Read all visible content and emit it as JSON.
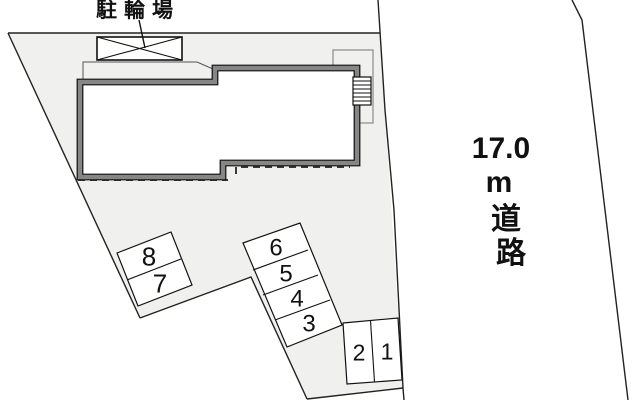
{
  "palette": {
    "background": "#ffffff",
    "plot_fill": "#f0f0ee",
    "line": "#222222",
    "thin_line": "#8a8a8a",
    "building_outline": "#111111",
    "building_band": "#868686",
    "cell_fill": "#ffffff",
    "text_color": "#111111"
  },
  "labels": {
    "bike_parking": {
      "text": "駐輪場",
      "x": 96,
      "y": 17,
      "font_size": 21,
      "letter_spacing": 7
    },
    "road": {
      "lines": [
        "17.0",
        "m",
        "道",
        "路"
      ],
      "xs": [
        501,
        499,
        506,
        511
      ],
      "ys": [
        158,
        192,
        229,
        263
      ],
      "font_size": 30
    }
  },
  "geometry": {
    "plot": {
      "points": "8,33 380,33 403,388 307,399 251,277 140,318"
    },
    "boundary_lines": [
      {
        "name": "plot-top-edge",
        "points": "8,33 380,33"
      },
      {
        "name": "plot-left-edge",
        "points": "8,33 140,318"
      },
      {
        "name": "plot-bottom-left-edge",
        "points": "140,318 251,277 307,399"
      },
      {
        "name": "plot-bottom-edge",
        "points": "307,399 403,388"
      }
    ],
    "road_lines": [
      {
        "name": "road-near-edge",
        "points": "378,0 385,110 394,210 403,388 404,400"
      },
      {
        "name": "road-far-edge",
        "points": "572,0 582,20 628,400"
      }
    ],
    "eaves_lines": [
      {
        "points": "78,180 228,180"
      },
      {
        "points": "236,174 236,167 350,167"
      }
    ],
    "bike_pad_outline": "83,81 83,62 197,62 213,69",
    "porch": {
      "x": 333,
      "y": 50,
      "w": 40,
      "h": 73
    },
    "building": {
      "points": "80,82 215,82 215,68 357,68 357,163 223,163 223,177 80,177"
    },
    "stairs": {
      "x": 353,
      "y": 77,
      "w": 18,
      "h": 28,
      "rung_ys": [
        81,
        85,
        89,
        93,
        97,
        101
      ]
    },
    "bike_box": {
      "x": 97,
      "y": 37,
      "w": 85,
      "h": 23
    },
    "leader_line": "139,20 145,48"
  },
  "parking": {
    "blocks": [
      {
        "name": "parking-block-8-7",
        "points": "117,253 171,232 192,285 138,306",
        "dividers": [
          "127,280 181,259"
        ],
        "font_size": 26,
        "spaces": [
          {
            "num": "8",
            "cx": 149,
            "cy": 256
          },
          {
            "num": "7",
            "cx": 160,
            "cy": 283
          }
        ]
      },
      {
        "name": "parking-block-6-5-4-3",
        "points": "243,243 300,223 342,325 287,347",
        "dividers": [
          "253,270 308,250",
          "263,295 318,275",
          "275,320 330,300"
        ],
        "font_size": 24,
        "spaces": [
          {
            "num": "6",
            "cx": 276,
            "cy": 247
          },
          {
            "num": "5",
            "cx": 286,
            "cy": 273
          },
          {
            "num": "4",
            "cx": 297,
            "cy": 298
          },
          {
            "num": "3",
            "cx": 309,
            "cy": 323
          }
        ]
      },
      {
        "name": "parking-block-2-1",
        "points": "343,323 398,318 402,380 347,384",
        "dividers": [
          "370.5,320.5 374.5,382"
        ],
        "font_size": 23,
        "spaces": [
          {
            "num": "2",
            "cx": 359,
            "cy": 352
          },
          {
            "num": "1",
            "cx": 387,
            "cy": 351
          }
        ]
      }
    ]
  }
}
